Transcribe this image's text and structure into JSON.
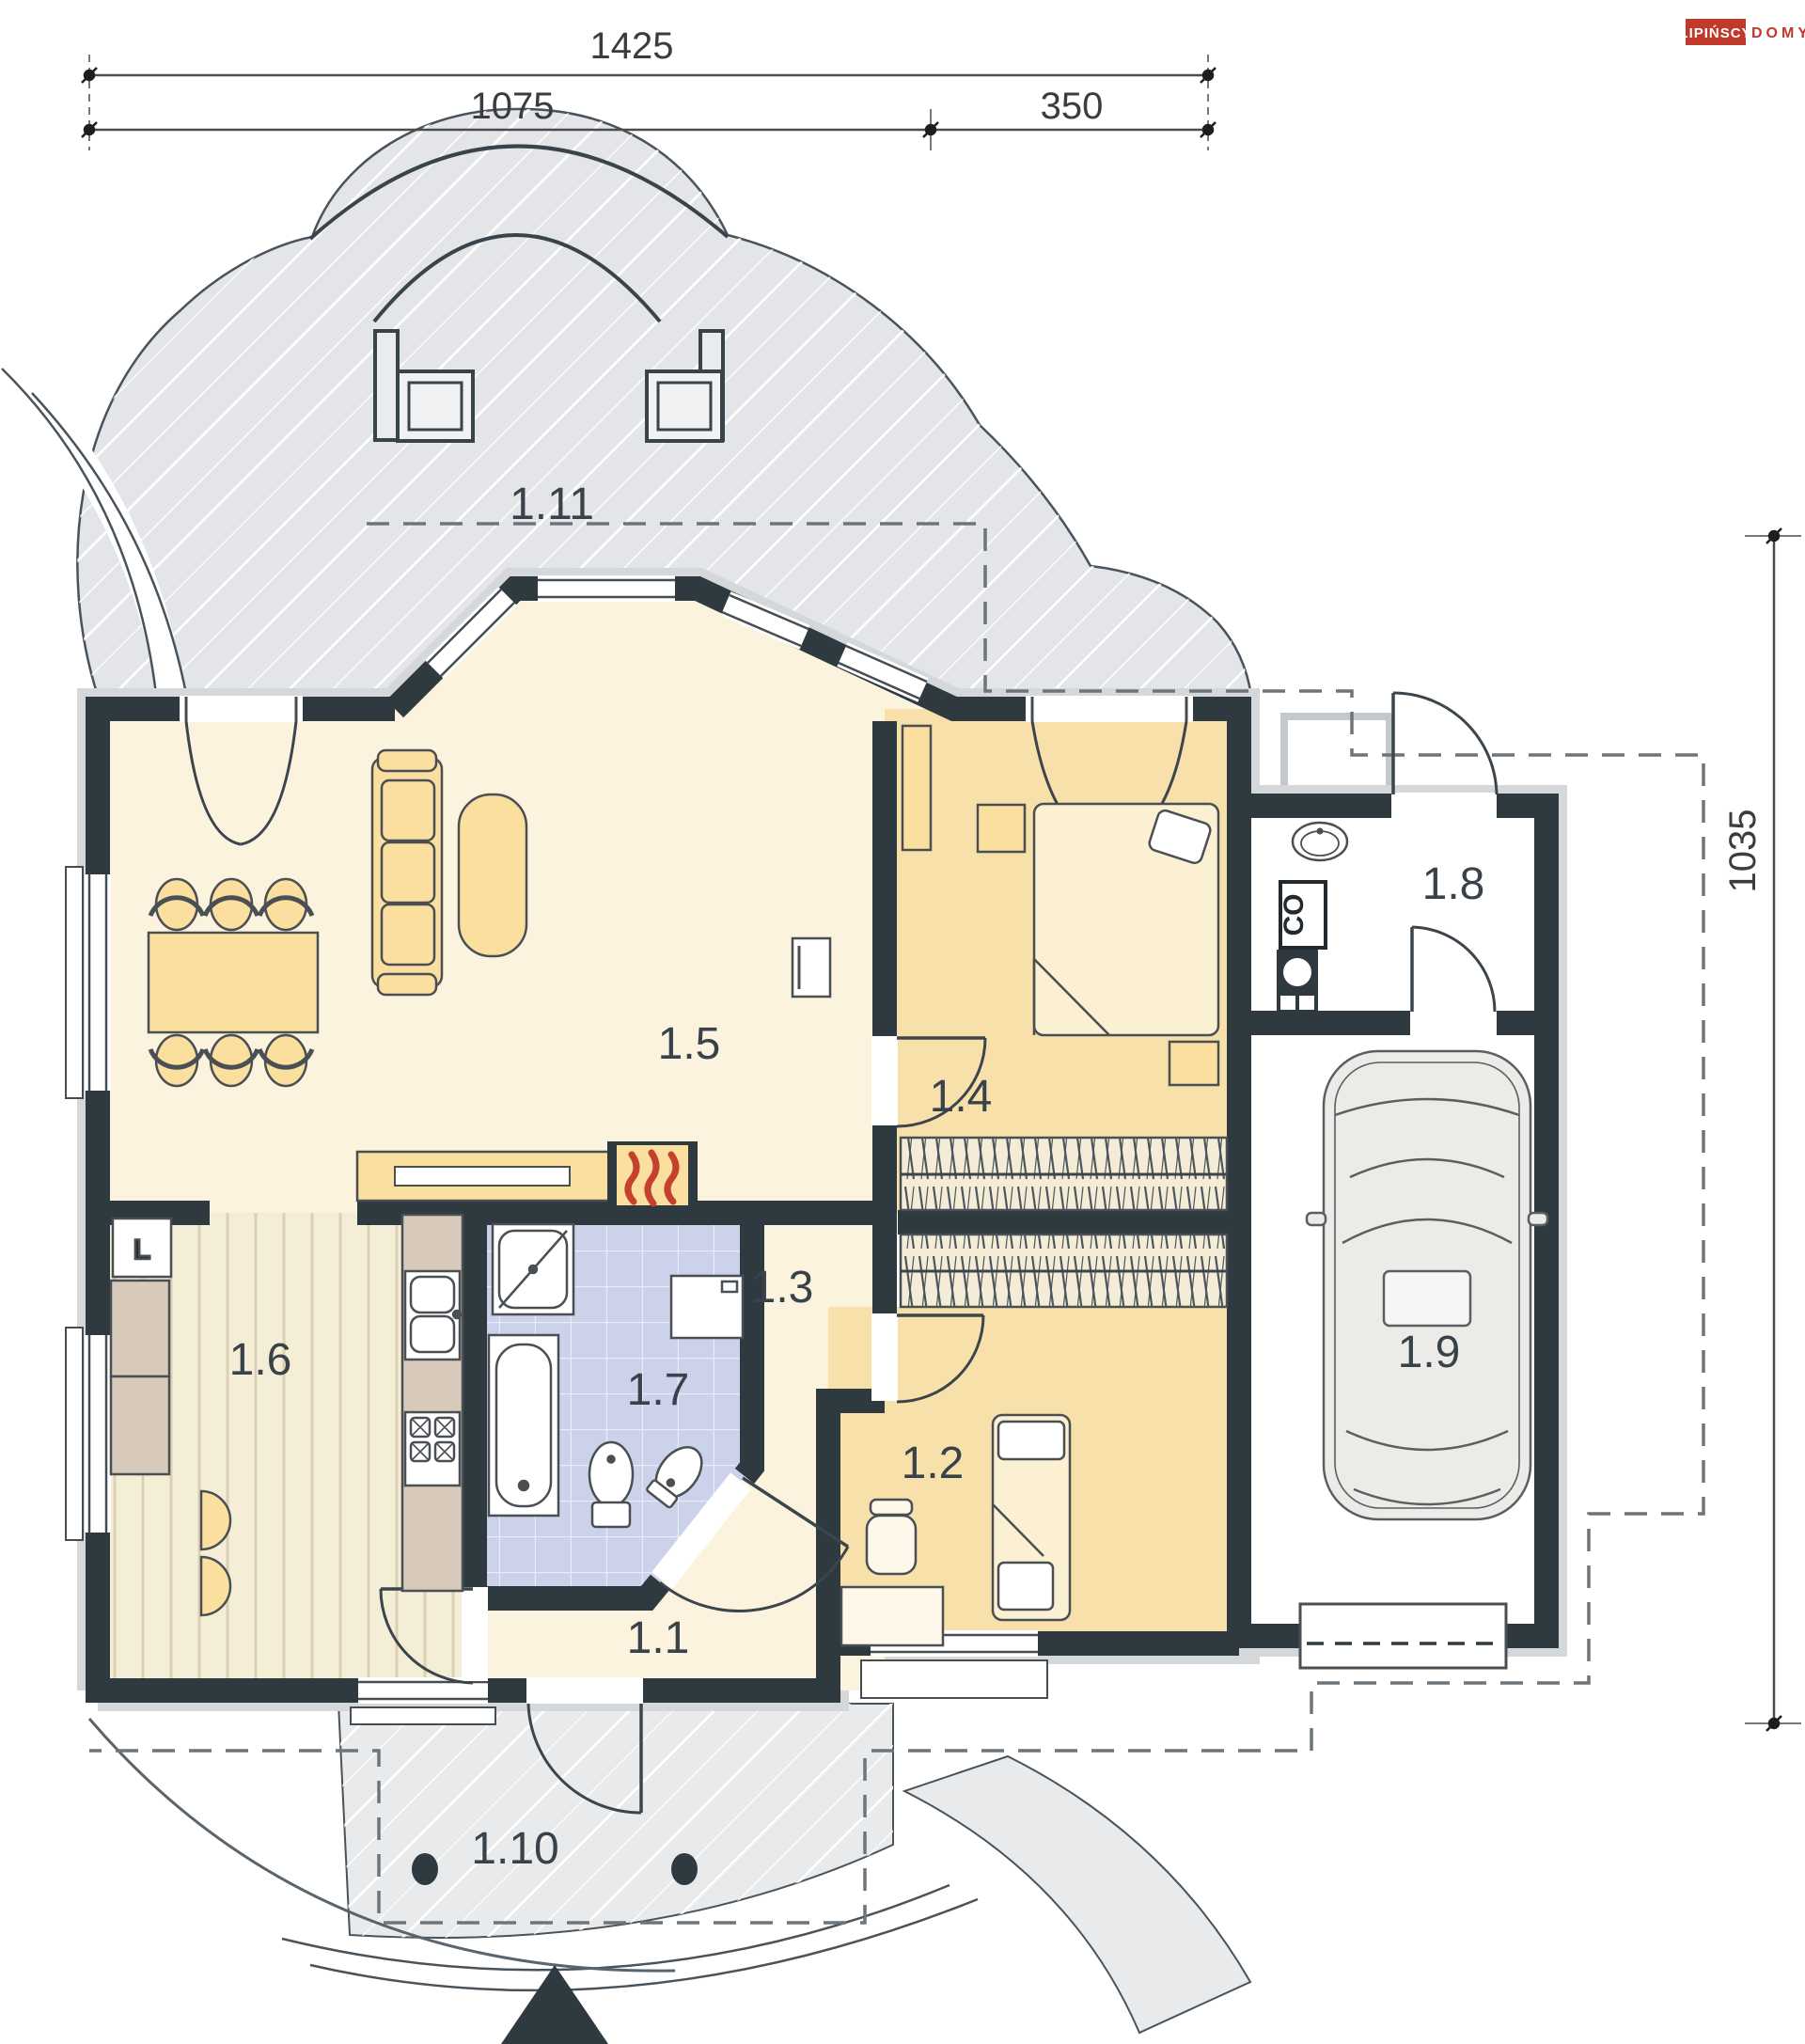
{
  "brand": {
    "name": "LIPIŃSCY",
    "suffix": "DOMY",
    "accent_color": "#c0392b"
  },
  "dimensions": {
    "total_width": "1425",
    "house_width": "1075",
    "garage_width": "350",
    "depth": "1035"
  },
  "rooms": [
    {
      "id": "1.1"
    },
    {
      "id": "1.2"
    },
    {
      "id": "1.3"
    },
    {
      "id": "1.4"
    },
    {
      "id": "1.5"
    },
    {
      "id": "1.6"
    },
    {
      "id": "1.7"
    },
    {
      "id": "1.8"
    },
    {
      "id": "1.9"
    },
    {
      "id": "1.10"
    },
    {
      "id": "1.11"
    }
  ],
  "markers": {
    "boiler": "CO",
    "fridge": "L"
  },
  "colors": {
    "wall": "#2e3940",
    "wall_halo": "#d4d8db",
    "floor_cream": "#fbf3dd",
    "floor_tan": "#f8e0ab",
    "furniture_tan": "#fadf9f",
    "terrace": "#e3e5e8",
    "tiles": "#cbd2e9",
    "kitchen_floor": "#f5eed6",
    "counter": "#d8cabb",
    "flame_red": "#c6402e"
  }
}
